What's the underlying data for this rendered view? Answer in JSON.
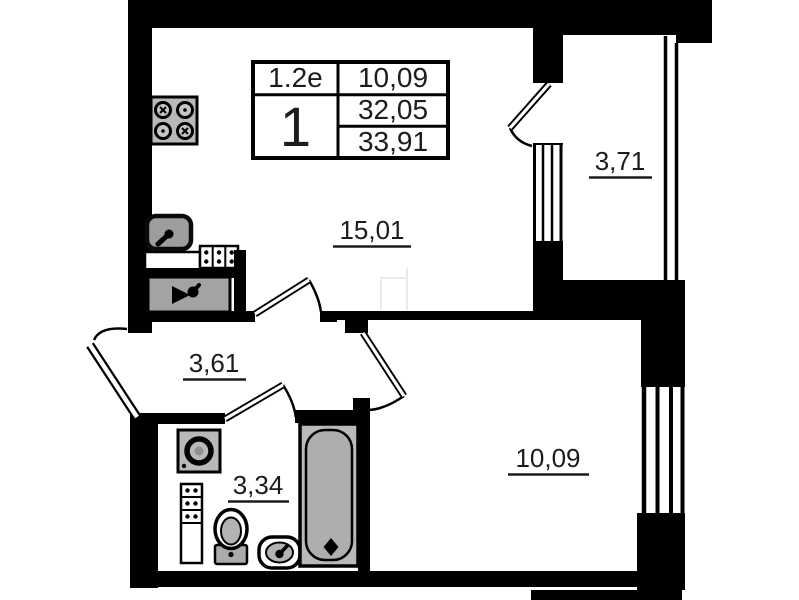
{
  "stamp_table": {
    "unit_code": "1.2e",
    "room_count": "1",
    "living_area": "10,09",
    "area_main": "32,05",
    "area_total": "33,91"
  },
  "room_labels": {
    "living_room": "15,01",
    "balcony": "3,71",
    "hallway": "3,61",
    "bathroom": "3,34",
    "bedroom": "10,09"
  },
  "fixtures": [
    "stove-icon",
    "kitchen-sink-icon",
    "kitchen-counter",
    "kitchen-cabinet-dots",
    "tap-unit-icon",
    "washing-machine-icon",
    "bathroom-shelf-unit",
    "toilet-icon",
    "washbasin-icon",
    "bathtub-icon"
  ],
  "colors": {
    "wall": "#000000",
    "fixture_fill": "#b9b9b9",
    "background": "#ffffff"
  }
}
